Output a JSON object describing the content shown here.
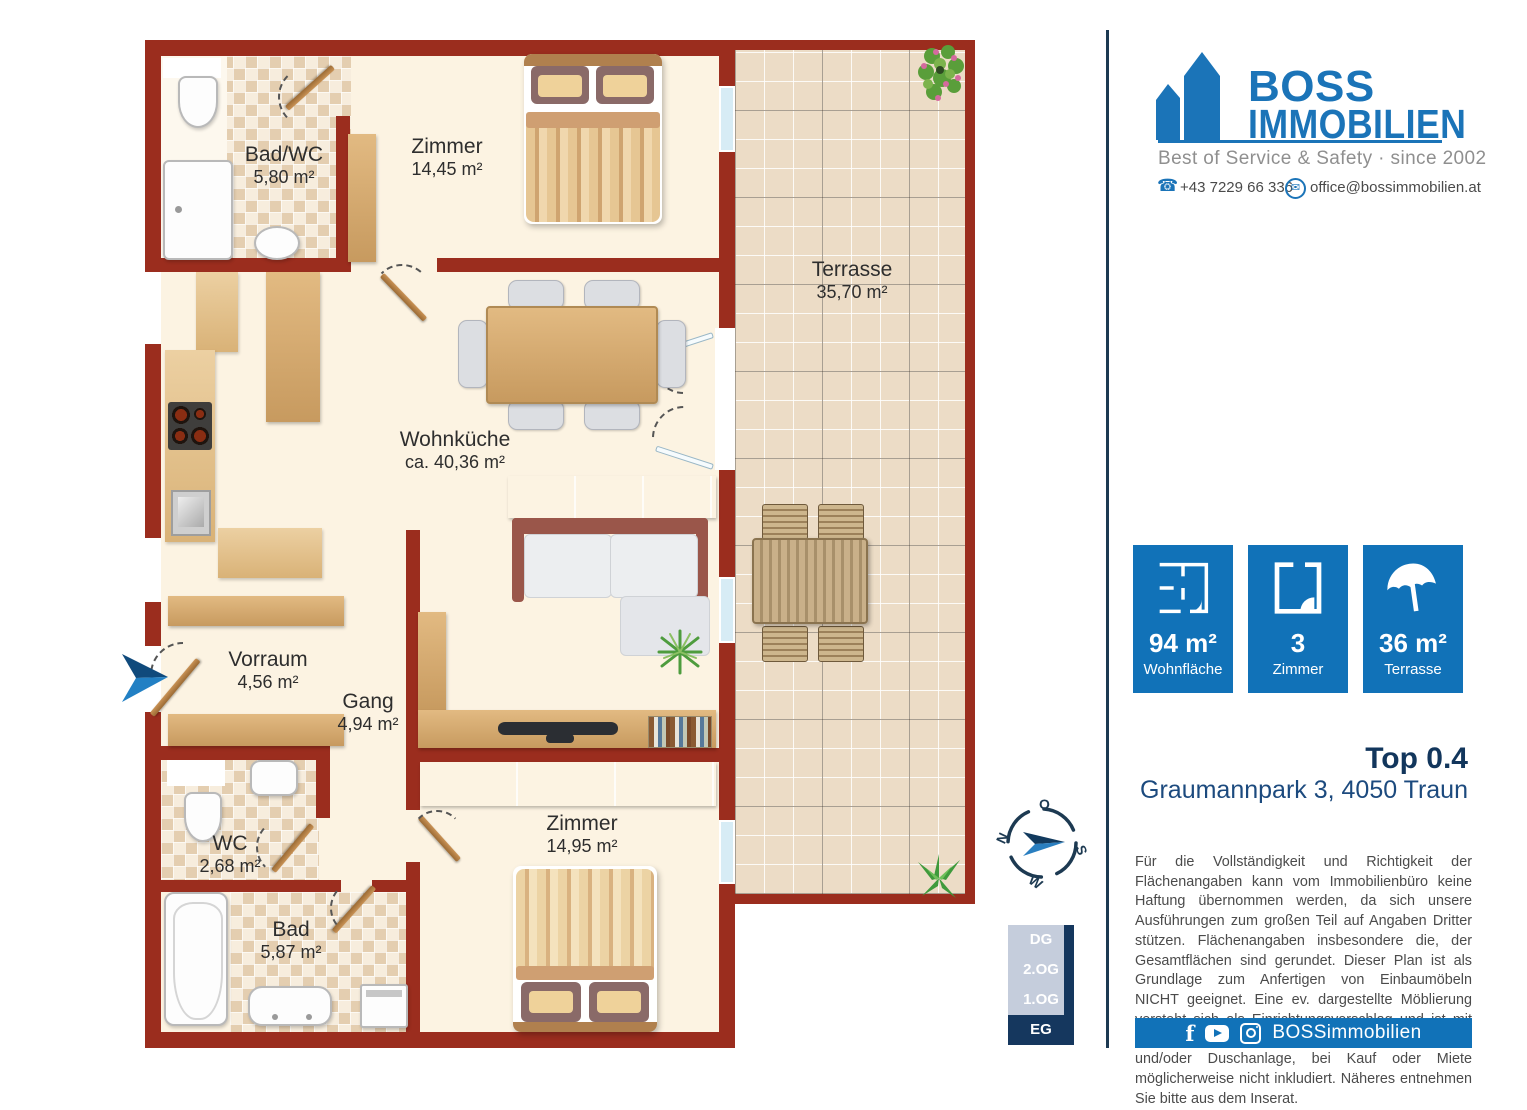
{
  "floor_plan": {
    "rooms": [
      {
        "id": "bad_wc",
        "name": "Bad/WC",
        "area": "5,80 m²"
      },
      {
        "id": "zimmer_top",
        "name": "Zimmer",
        "area": "14,45 m²"
      },
      {
        "id": "terrasse",
        "name": "Terrasse",
        "area": "35,70 m²"
      },
      {
        "id": "wohnkueche",
        "name": "Wohnküche",
        "area": "ca. 40,36 m²"
      },
      {
        "id": "vorraum",
        "name": "Vorraum",
        "area": "4,56 m²"
      },
      {
        "id": "gang",
        "name": "Gang",
        "area": "4,94 m²"
      },
      {
        "id": "wc",
        "name": "WC",
        "area": "2,68 m²"
      },
      {
        "id": "bad",
        "name": "Bad",
        "area": "5,87 m²"
      },
      {
        "id": "zimmer_bottom",
        "name": "Zimmer",
        "area": "14,95 m²"
      }
    ]
  },
  "branding": {
    "name_line1": "BOSS",
    "name_line2": "IMMOBILIEN",
    "tagline": "Best of Service & Safety · since 2002",
    "phone": "+43 7229 66 336",
    "email": "office@bossimmobilien.at"
  },
  "stats": [
    {
      "value": "94 m²",
      "label": "Wohnfläche"
    },
    {
      "value": "3",
      "label": "Zimmer"
    },
    {
      "value": "36 m²",
      "label": "Terrasse"
    }
  ],
  "unit": {
    "title": "Top 0.4",
    "address": "Graumannpark 3, 4050 Traun"
  },
  "compass": {
    "n": "N",
    "e": "O",
    "s": "S",
    "w": "W"
  },
  "disclaimer": "Für die Vollständigkeit und Richtigkeit der Flächenangaben kann vom Immobilienbüro keine Haftung übernommen werden, da sich unsere Ausführungen zum großen Teil auf Angaben Dritter stützen. Flächenangaben insbesondere die, der Gesamtflächen sind gerundet. Dieser Plan ist als Grundlage zum Anfertigen von Einbaumöbeln NICHT geeignet. Eine ev. dargestellte Möblierung versteht sich als Einrichtungsvorschlag und ist mit Ausnahme der Sanitärkeramik, Badewanne und/oder Duschanlage, bei Kauf oder Miete möglicherweise nicht inkludiert. Näheres entnehmen Sie bitte aus dem Inserat.",
  "floors": {
    "levels": [
      "DG",
      "2.OG",
      "1.OG",
      "EG"
    ],
    "active": "EG"
  },
  "footer": {
    "social_handle": "BOSSimmobilien"
  },
  "colors": {
    "brand_blue": "#1172b8",
    "navy": "#15375e",
    "wall_red": "#9b2d1e"
  }
}
